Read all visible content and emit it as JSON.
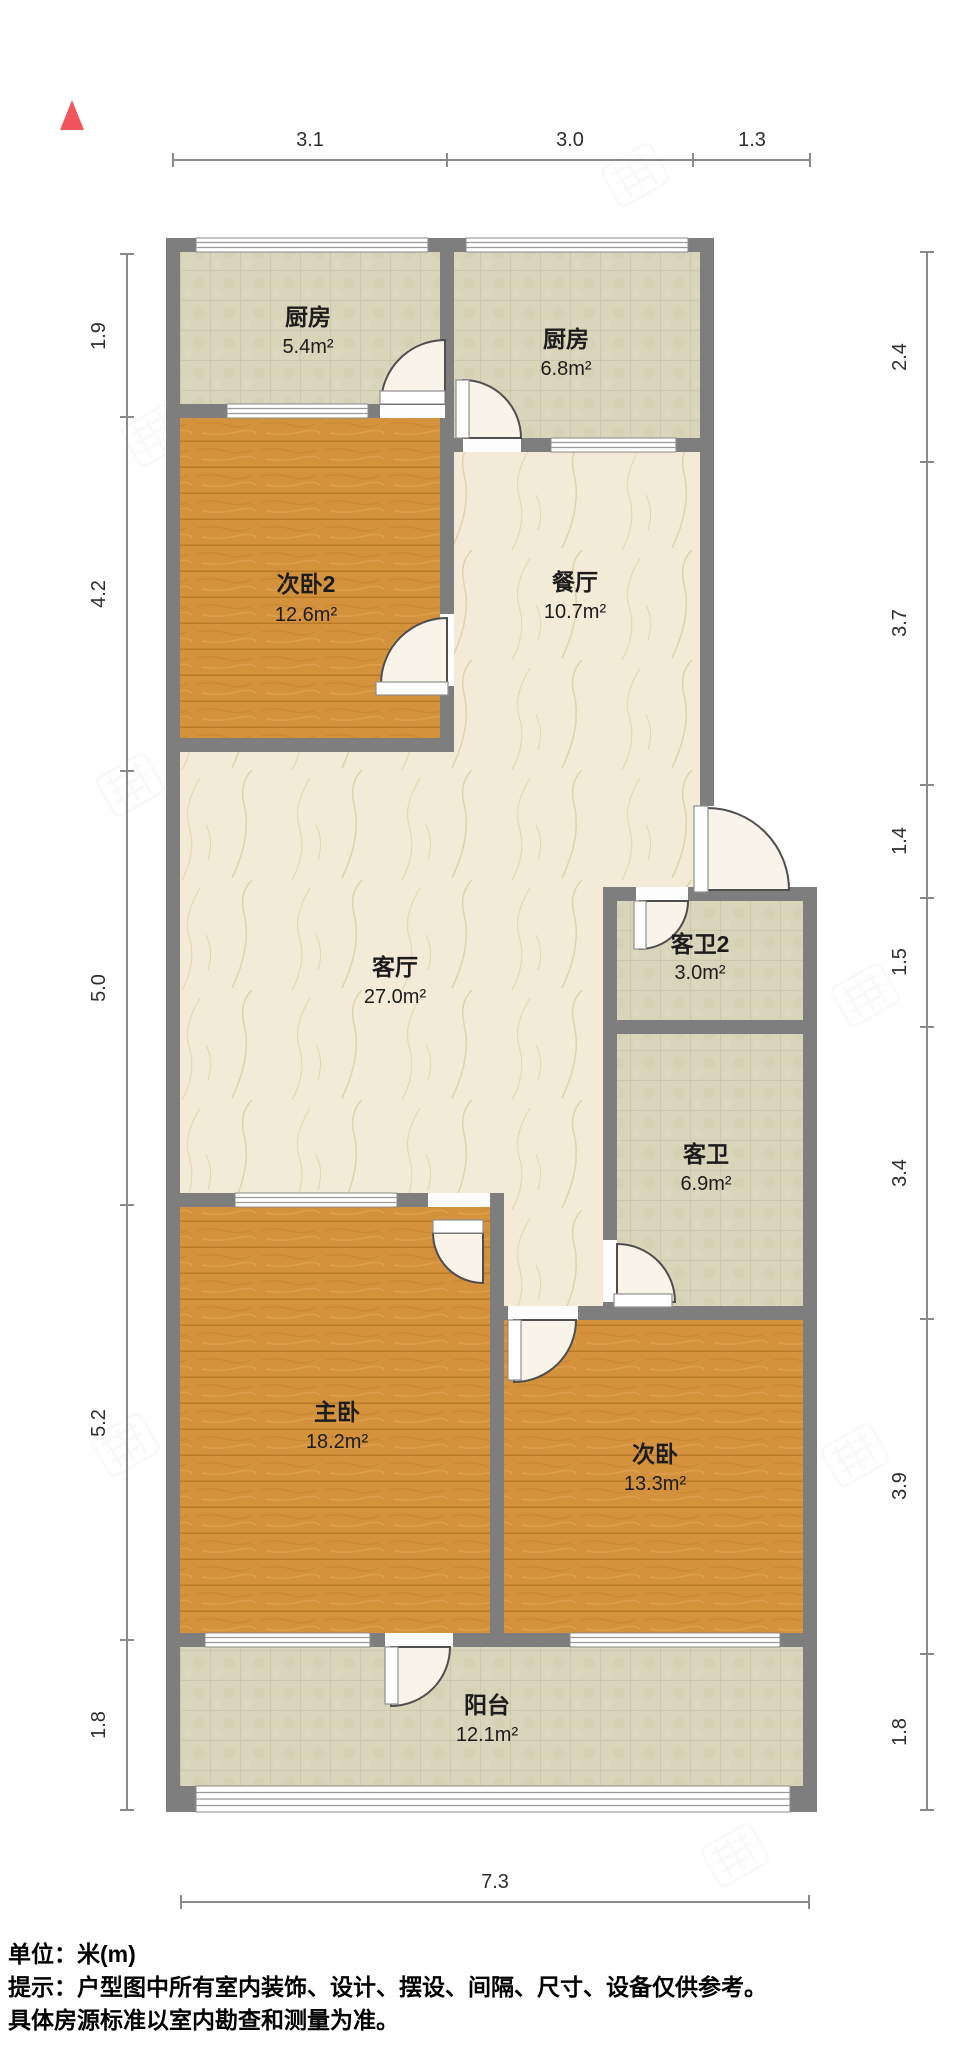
{
  "meta": {
    "type": "apartment-floorplan",
    "accent_color": "#f2545b",
    "wall_color": "#7e7e7e",
    "wood_floor_color": "#d5923c",
    "tile_floor_color": "#d9d5bb",
    "marble_floor_color": "#f3ebd7"
  },
  "rooms": {
    "kitchen_left": {
      "name": "厨房",
      "area": "5.4m²"
    },
    "kitchen_right": {
      "name": "厨房",
      "area": "6.8m²"
    },
    "bedroom2_upper": {
      "name": "次卧2",
      "area": "12.6m²"
    },
    "dining": {
      "name": "餐厅",
      "area": "10.7m²"
    },
    "living": {
      "name": "客厅",
      "area": "27.0m²"
    },
    "guest_bath2": {
      "name": "客卫2",
      "area": "3.0m²"
    },
    "guest_bath": {
      "name": "客卫",
      "area": "6.9m²"
    },
    "master_bedroom": {
      "name": "主卧",
      "area": "18.2m²"
    },
    "bedroom2_lower": {
      "name": "次卧",
      "area": "13.3m²"
    },
    "balcony": {
      "name": "阳台",
      "area": "12.1m²"
    }
  },
  "dimensions": {
    "top": [
      "3.1",
      "3.0",
      "1.3"
    ],
    "left": [
      "1.9",
      "4.2",
      "5.0",
      "5.2",
      "1.8"
    ],
    "right": [
      "2.4",
      "3.7",
      "1.4",
      "1.5",
      "3.4",
      "3.9",
      "1.8"
    ],
    "bottom": [
      "7.3"
    ]
  },
  "footer": {
    "unit": "单位：米(m)",
    "tip": "提示：户型图中所有室内装饰、设计、摆设、间隔、尺寸、设备仅供参考。",
    "tip2": "具体房源标准以室内勘查和测量为准。"
  }
}
